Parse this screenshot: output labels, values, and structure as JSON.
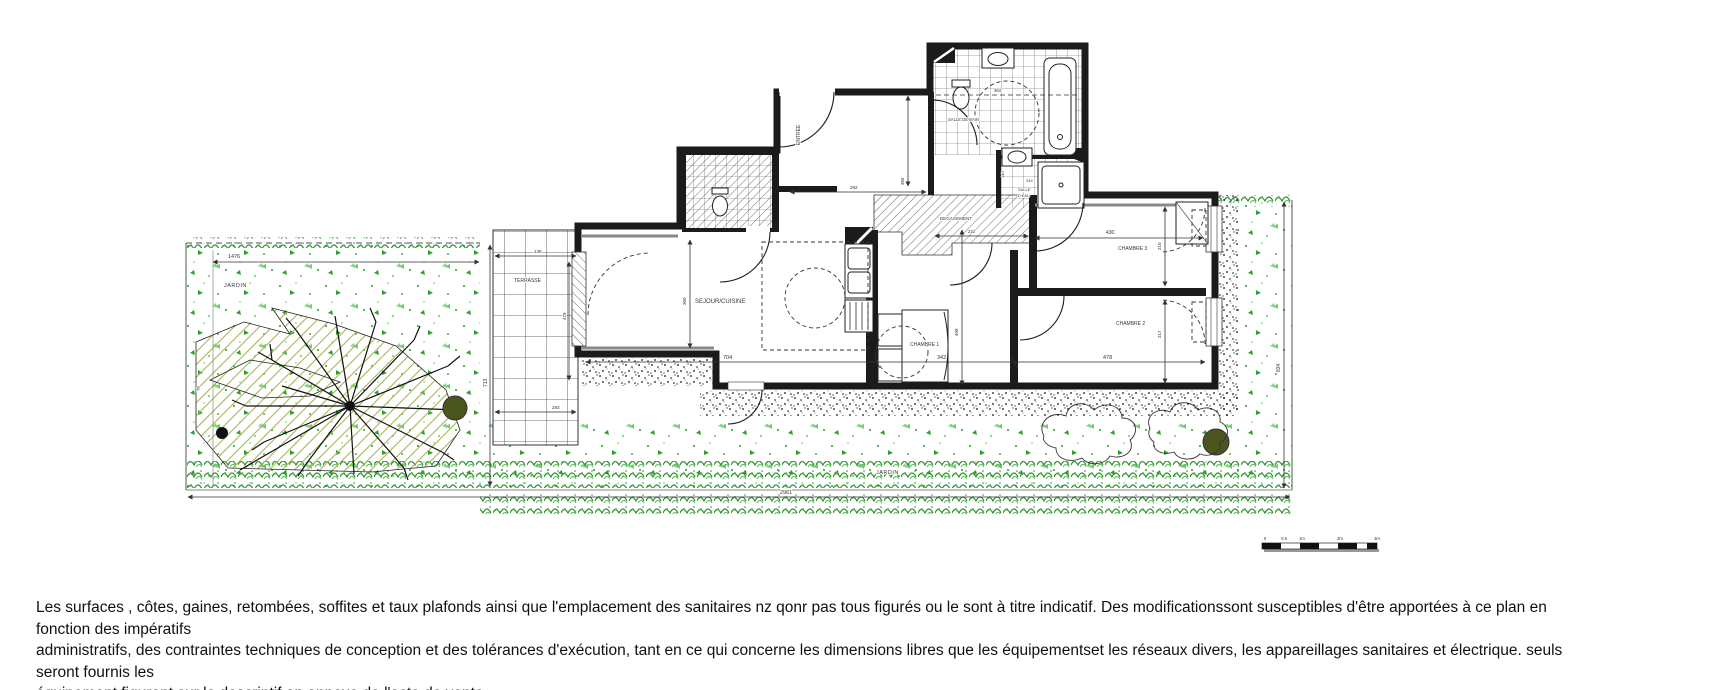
{
  "plan": {
    "rooms": {
      "jardin1": "JARDIN",
      "jardin2": "JARDIN",
      "terrasse": "TERRASSE",
      "sejour": "SEJOUR/CUISINE",
      "chambre1": "CHAMBRE 1",
      "chambre2": "CHAMBRE 2",
      "chambre3": "CHAMBRE 3",
      "entree": "ENTRÉE",
      "salle_de_bain": "SALLE DE BAIN",
      "salle_deau_l1": "SALLE",
      "salle_deau_l2": "D'EAU",
      "degagement": "DEGAGEMENT"
    },
    "dims": {
      "jardin_left_w": "1476",
      "jardin_left_h": "713",
      "jardin_edge": "79",
      "jardin_bottom_w": "2961",
      "jardin_right_h": "834",
      "terrasse_w": "138",
      "terrasse_h": "479",
      "terrasse_b": "283",
      "sejour_w": "704",
      "sejour_h": "360",
      "chambre1_w": "342",
      "chambre1_h": "408",
      "chambre2_w": "478",
      "chambre2_h": "217",
      "chambre3_w": "430",
      "chambre3_h": "210",
      "entree_w": "282",
      "entree_h": "365",
      "sdb_w": "364",
      "sde_h": "140",
      "sde_w": "244",
      "degagement_w": "222"
    },
    "scalebar": {
      "t0": "0",
      "t05": "0,5",
      "t1": "1m",
      "t2": "2m",
      "t3": "3m"
    }
  },
  "disclaimer": {
    "line1": "Les surfaces , côtes, gaines, retombées, soffites et taux plafonds ainsi que l'emplacement des sanitaires nz qonr pas tous figurés ou le sont à titre indicatif. Des modificationssont susceptibles d'être apportées à ce plan en fonction des impératifs",
    "line2": "administratifs, des contraintes techniques de conception et des tolérances d'exécution, tant en ce qui concerne les dimensions libres que les équipementset les réseaux divers, les appareillages sanitaires et électrique. seuls seront fournis les",
    "line3": "équipement figurant sur le descriptif en annexe de l'acte de vente."
  },
  "colors": {
    "wall": "#1b1b1b",
    "speckle-green": "#3cb83c",
    "speckle-light": "#86d786",
    "hedge-green": "#2f8f2f",
    "olive-hatch": "#a9b65a",
    "tree-fill": "#4a5520",
    "dim-text": "#333333"
  }
}
